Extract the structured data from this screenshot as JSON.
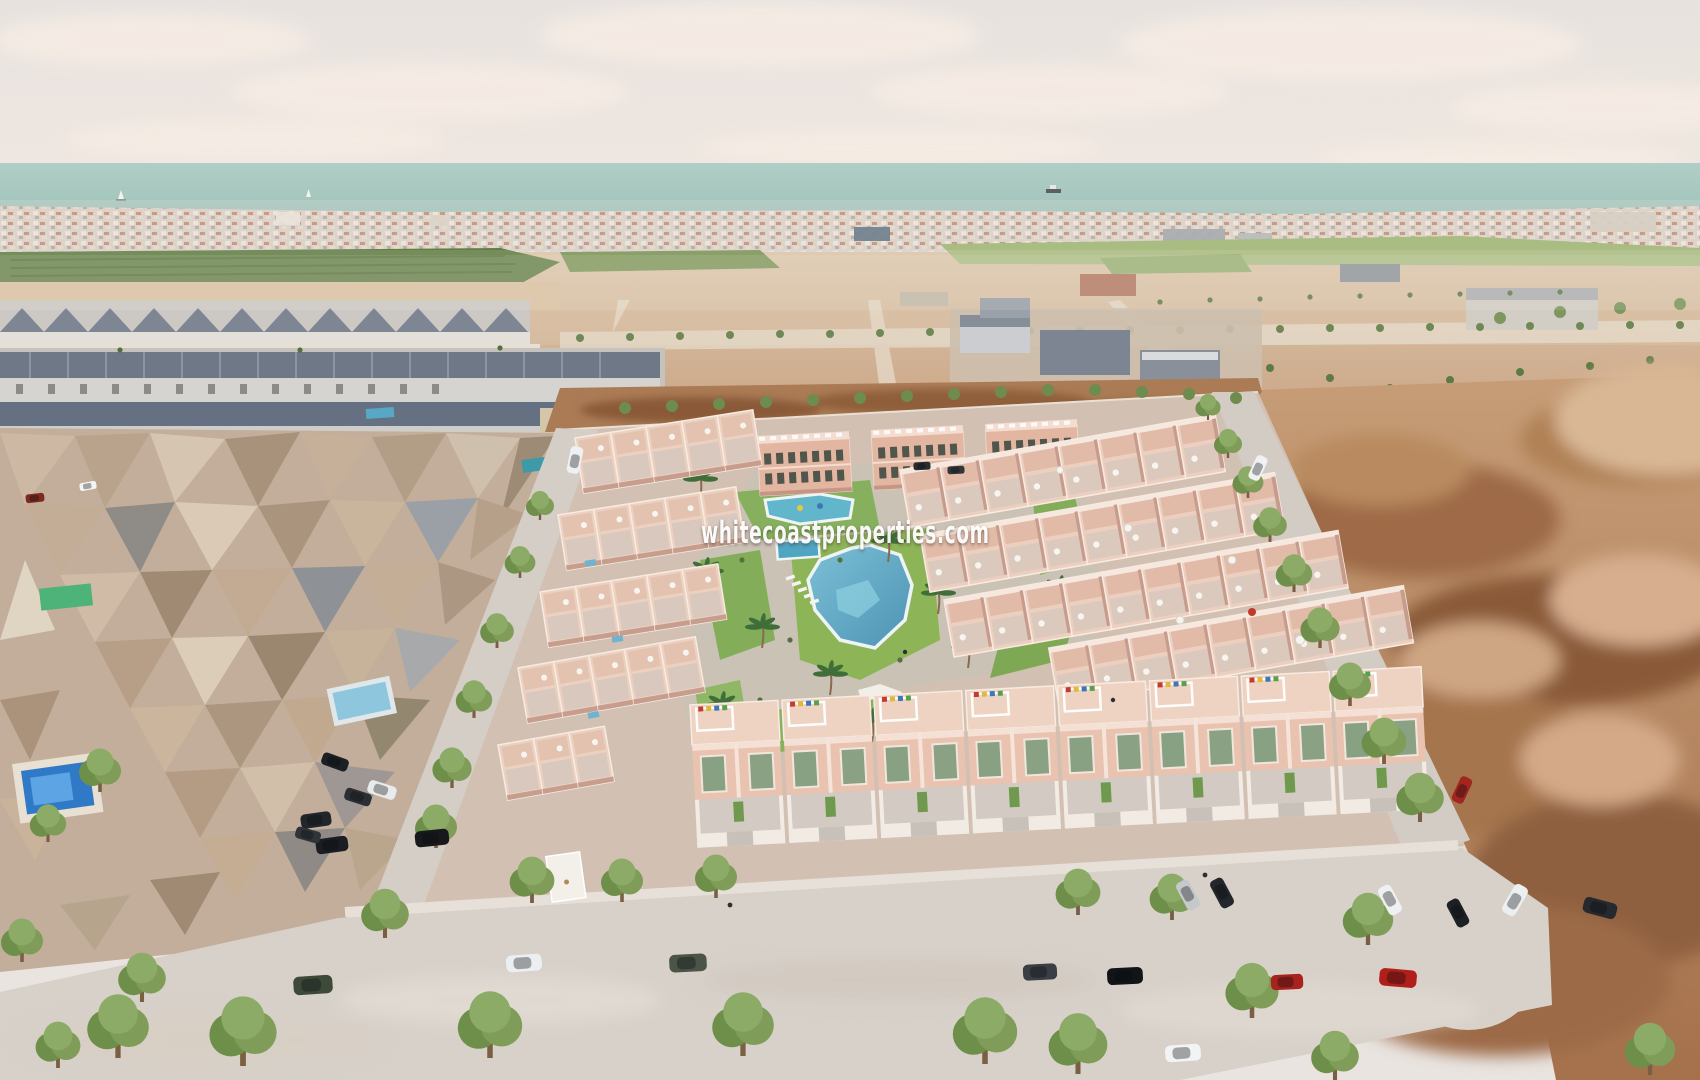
{
  "watermark": {
    "text": "whitecoastproperties.com",
    "color": "#ffffff"
  },
  "scene": {
    "type": "aerial-3d-architectural-render",
    "subject": "new-build residential development with communal lagoon pool beside existing neighbourhood, vacant plots and sea horizon"
  },
  "palette": {
    "sky": "#e9e4e0",
    "clouds": "#f5ece5",
    "sea": "#a8c9c0",
    "horizon_town": "#d8cfc5",
    "orchard": "#617e45",
    "field_green": "#a9bc82",
    "midground_dirt": "#d6bb9c",
    "plot_dirt_dark": "#a97450",
    "mesh_houses": "#c2ae9a",
    "existing_roofs": "#6e7886",
    "new_build_wall": "#ecc9b8",
    "new_build_trim": "#f6e8de",
    "window_green": "#8aa184",
    "lawn": "#84ad5a",
    "street_tree": "#7f9d58",
    "palm": "#3f6e38",
    "lagoon_pool": "#5fa8c4",
    "private_pool": "#2f79c6",
    "road": "#d7d1ca",
    "sidewalk": "#e6e0d8"
  },
  "objects": {
    "boats": [
      "sailboat",
      "sailboat",
      "cargo-ship"
    ],
    "car_colors": [
      "white",
      "black",
      "olive-green",
      "dark-grey",
      "red",
      "silver"
    ]
  }
}
